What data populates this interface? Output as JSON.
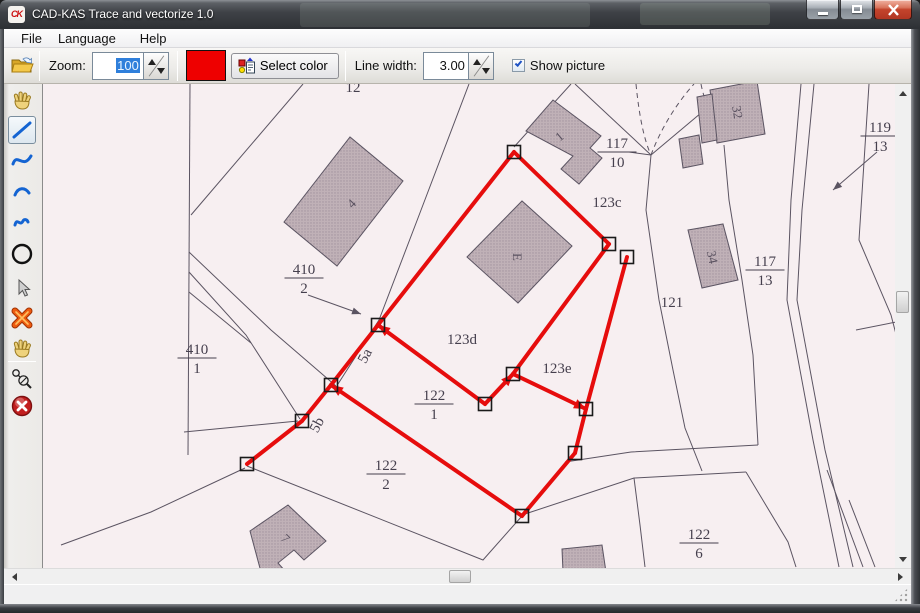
{
  "window": {
    "title": "CAD-KAS Trace and vectorize 1.0",
    "logo_text": "CK"
  },
  "menu": {
    "items": [
      "File",
      "Language",
      "Help"
    ]
  },
  "toolbar": {
    "zoom_label": "Zoom:",
    "zoom_value": "100",
    "select_color_label": "Select color",
    "line_width_label": "Line width:",
    "line_width_value": "3.00",
    "show_picture_label": "Show picture",
    "color_swatch": "#ee0000"
  },
  "tools": [
    "pan-hand",
    "line",
    "s-curve",
    "arc",
    "squiggle",
    "circle",
    "pointer",
    "delete-x",
    "move-hand",
    "trace-nodes",
    "cancel"
  ],
  "map": {
    "paper": "#f7eff1",
    "line_color": "#5b5462",
    "text_color": "#453f4d",
    "building_fill": "#c0b1b7",
    "polylines": [
      [
        189,
        84,
        187,
        455
      ],
      [
        190,
        215,
        302,
        84
      ],
      [
        468,
        84,
        417,
        218,
        378,
        320,
        337,
        384
      ],
      [
        188,
        252,
        270,
        330,
        335,
        386
      ],
      [
        188,
        272,
        245,
        335,
        299,
        419
      ],
      [
        188,
        292,
        250,
        343
      ],
      [
        183,
        432,
        297,
        421
      ],
      [
        244,
        468,
        150,
        512,
        60,
        545
      ],
      [
        246,
        466,
        482,
        560,
        521,
        516
      ],
      [
        513,
        147,
        570,
        84
      ],
      [
        650,
        155,
        574,
        84
      ],
      [
        628,
        152,
        650,
        155
      ],
      [
        650,
        155,
        700,
        113
      ],
      [
        650,
        155,
        645,
        210,
        658,
        300,
        672,
        370,
        684,
        428,
        701,
        471
      ],
      [
        524,
        514,
        633,
        478,
        745,
        472
      ],
      [
        564,
        462,
        630,
        452,
        757,
        445
      ],
      [
        757,
        445,
        752,
        355,
        741,
        280,
        728,
        200,
        723,
        145
      ],
      [
        745,
        472,
        787,
        542,
        795,
        567
      ],
      [
        633,
        478,
        639,
        525,
        644,
        567
      ],
      [
        800,
        84,
        790,
        200,
        786,
        300,
        812,
        440,
        838,
        567
      ],
      [
        813,
        84,
        801,
        210,
        796,
        300,
        824,
        450,
        852,
        567
      ],
      [
        826,
        470,
        862,
        567
      ],
      [
        848,
        500,
        874,
        567
      ],
      [
        868,
        84,
        858,
        240,
        890,
        315,
        896,
        338
      ],
      [
        855,
        330,
        895,
        322
      ],
      [
        307,
        295,
        360,
        314
      ],
      [
        876,
        152,
        832,
        190
      ]
    ],
    "dashed": [
      "M635,84 C638,115 643,140 650,155",
      "M650,155 C660,128 676,103 693,84",
      "M700,84 C703,100 709,112 716,120"
    ],
    "gray_arrows": [
      [
        360,
        314,
        20
      ],
      [
        832,
        190,
        140
      ]
    ],
    "buildings": [
      {
        "pts": "283,222 349,137 402,181 336,266",
        "label": "4",
        "lx": 350,
        "ly": 203,
        "rot": -45
      },
      {
        "pts": "525,131 552,100 600,136 589,148 601,158 578,184 560,169 572,156",
        "label": "1",
        "lx": 558,
        "ly": 136,
        "rot": -40
      },
      {
        "pts": "466,257 521,201 571,246 517,303",
        "label": "E",
        "lx": 517,
        "ly": 257,
        "rot": 90
      },
      {
        "pts": "687,230 722,224 737,280 701,288",
        "label": "34",
        "lx": 712,
        "ly": 257,
        "rot": 78
      },
      {
        "pts": "709,90 756,81 764,134 716,143",
        "label": "32",
        "lx": 737,
        "ly": 112,
        "rot": 80
      },
      {
        "pts": "696,97 711,94 716,140 701,143",
        "label": "",
        "lx": 0,
        "ly": 0,
        "rot": 0
      },
      {
        "pts": "678,139 698,135 702,164 682,168",
        "label": "",
        "lx": 0,
        "ly": 0,
        "rot": 0
      },
      {
        "pts": "249,531 287,505 325,541 303,560 293,550 277,563 285,572 260,572",
        "label": "7",
        "lx": 285,
        "ly": 538,
        "rot": 45
      },
      {
        "pts": "561,549 601,545 605,572 562,572",
        "label": "",
        "lx": 0,
        "ly": 0,
        "rot": 0
      }
    ],
    "labels": [
      {
        "t": "12",
        "x": 352,
        "y": 92,
        "rot": 0
      },
      {
        "t": "123c",
        "x": 606,
        "y": 207,
        "rot": 0
      },
      {
        "t": "121",
        "x": 671,
        "y": 307,
        "rot": 0
      },
      {
        "t": "123d",
        "x": 461,
        "y": 344,
        "rot": 0
      },
      {
        "t": "123e",
        "x": 556,
        "y": 373,
        "rot": 0
      },
      {
        "t": "5a",
        "x": 368,
        "y": 358,
        "rot": -62
      },
      {
        "t": "5b",
        "x": 320,
        "y": 427,
        "rot": -62
      }
    ],
    "fractions": [
      {
        "top": "410",
        "bot": "2",
        "x": 303,
        "y": 278
      },
      {
        "top": "410",
        "bot": "1",
        "x": 196,
        "y": 358
      },
      {
        "top": "117",
        "bot": "10",
        "x": 616,
        "y": 152
      },
      {
        "top": "117",
        "bot": "13",
        "x": 764,
        "y": 270
      },
      {
        "top": "119",
        "bot": "13",
        "x": 879,
        "y": 136
      },
      {
        "top": "122",
        "bot": "1",
        "x": 433,
        "y": 404
      },
      {
        "top": "122",
        "bot": "2",
        "x": 385,
        "y": 474
      },
      {
        "top": "122",
        "bot": "6",
        "x": 698,
        "y": 543
      }
    ],
    "trace": {
      "color": "#e60d0d",
      "width": 4,
      "segments": [
        [
          513,
          152,
          608,
          244
        ],
        [
          513,
          152,
          377,
          325
        ],
        [
          377,
          325,
          330,
          385
        ],
        [
          330,
          385,
          301,
          421
        ],
        [
          301,
          421,
          246,
          464
        ],
        [
          330,
          385,
          521,
          516
        ],
        [
          377,
          325,
          484,
          404
        ],
        [
          484,
          404,
          512,
          374
        ],
        [
          512,
          374,
          608,
          244
        ],
        [
          512,
          374,
          585,
          409
        ],
        [
          626,
          257,
          585,
          409
        ],
        [
          585,
          409,
          574,
          453
        ],
        [
          574,
          453,
          521,
          516
        ]
      ],
      "handles": [
        [
          513,
          152
        ],
        [
          608,
          244
        ],
        [
          626,
          257
        ],
        [
          377,
          325
        ],
        [
          330,
          385
        ],
        [
          301,
          421
        ],
        [
          246,
          464
        ],
        [
          484,
          404
        ],
        [
          512,
          374
        ],
        [
          585,
          409
        ],
        [
          574,
          453
        ],
        [
          521,
          516
        ]
      ],
      "arrows": [
        [
          377,
          325,
          -144
        ],
        [
          330,
          385,
          -146
        ],
        [
          512,
          374,
          -47
        ],
        [
          585,
          409,
          26
        ]
      ]
    }
  },
  "scrollbars": {
    "h_thumb_x": 449,
    "v_thumb_y": 291
  }
}
